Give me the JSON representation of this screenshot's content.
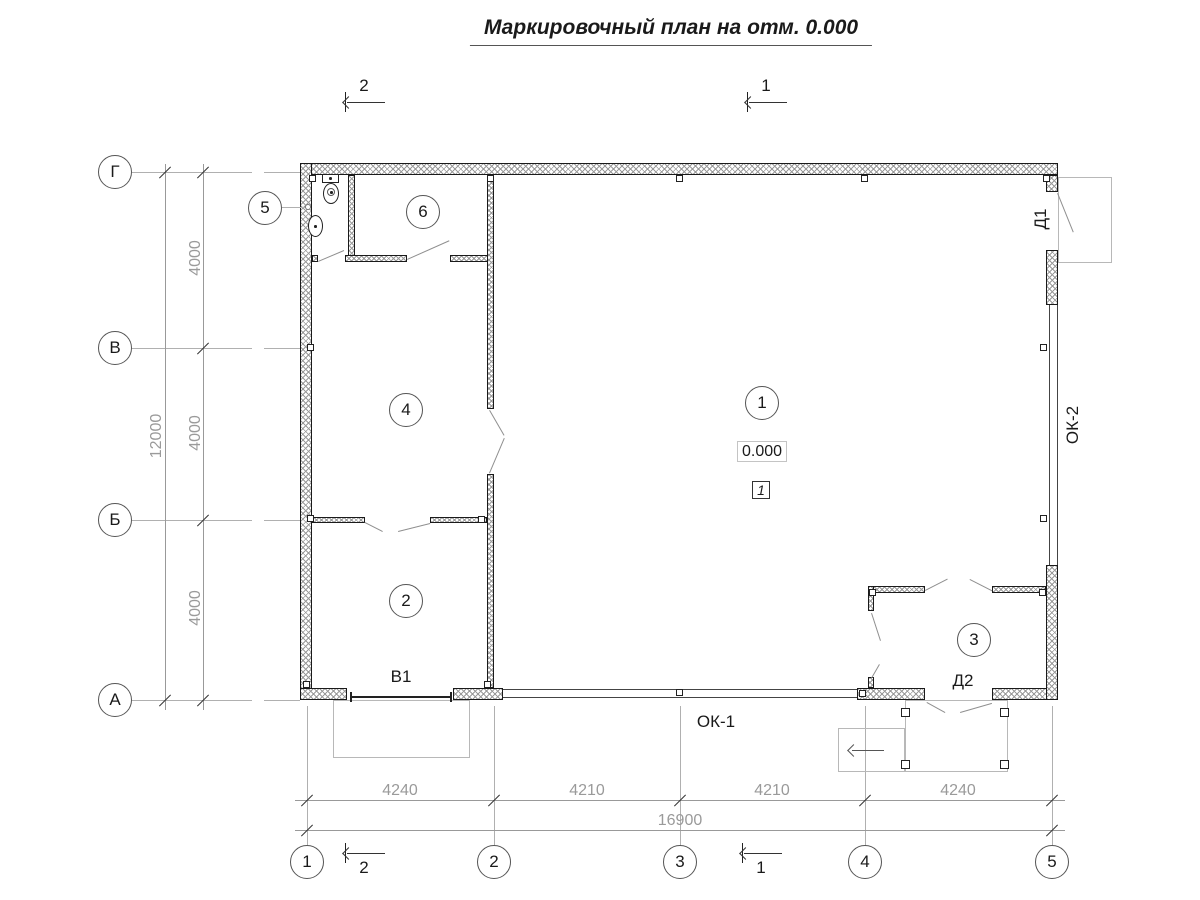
{
  "title": "Маркировочный план на отм. 0.000",
  "grid": {
    "rows": [
      {
        "label": "Г"
      },
      {
        "label": "В"
      },
      {
        "label": "Б"
      },
      {
        "label": "А"
      }
    ],
    "cols": [
      {
        "label": "1"
      },
      {
        "label": "2"
      },
      {
        "label": "3"
      },
      {
        "label": "4"
      },
      {
        "label": "5"
      }
    ]
  },
  "sections": {
    "section_1": "1",
    "section_2": "2"
  },
  "dimensions": {
    "bottom_segments": [
      {
        "value": "4240"
      },
      {
        "value": "4210"
      },
      {
        "value": "4210"
      },
      {
        "value": "4240"
      }
    ],
    "bottom_total": "16900",
    "left_segments": [
      {
        "value": "4000"
      },
      {
        "value": "4000"
      },
      {
        "value": "4000"
      }
    ],
    "left_total": "12000"
  },
  "rooms": [
    {
      "number": "1"
    },
    {
      "number": "2"
    },
    {
      "number": "3"
    },
    {
      "number": "4"
    },
    {
      "number": "5"
    },
    {
      "number": "6"
    }
  ],
  "marks": {
    "door_1": "Д1",
    "door_2": "Д2",
    "gate": "В1",
    "window_1": "ОК-1",
    "window_2": "ОК-2"
  },
  "elevation": {
    "value": "0.000",
    "zone": "1"
  },
  "colors": {
    "wall_line": "#1a1a1a",
    "hatch": "#9a9a9a",
    "dim_text": "#9a9a9a",
    "aux_line": "#b0b0b0"
  }
}
